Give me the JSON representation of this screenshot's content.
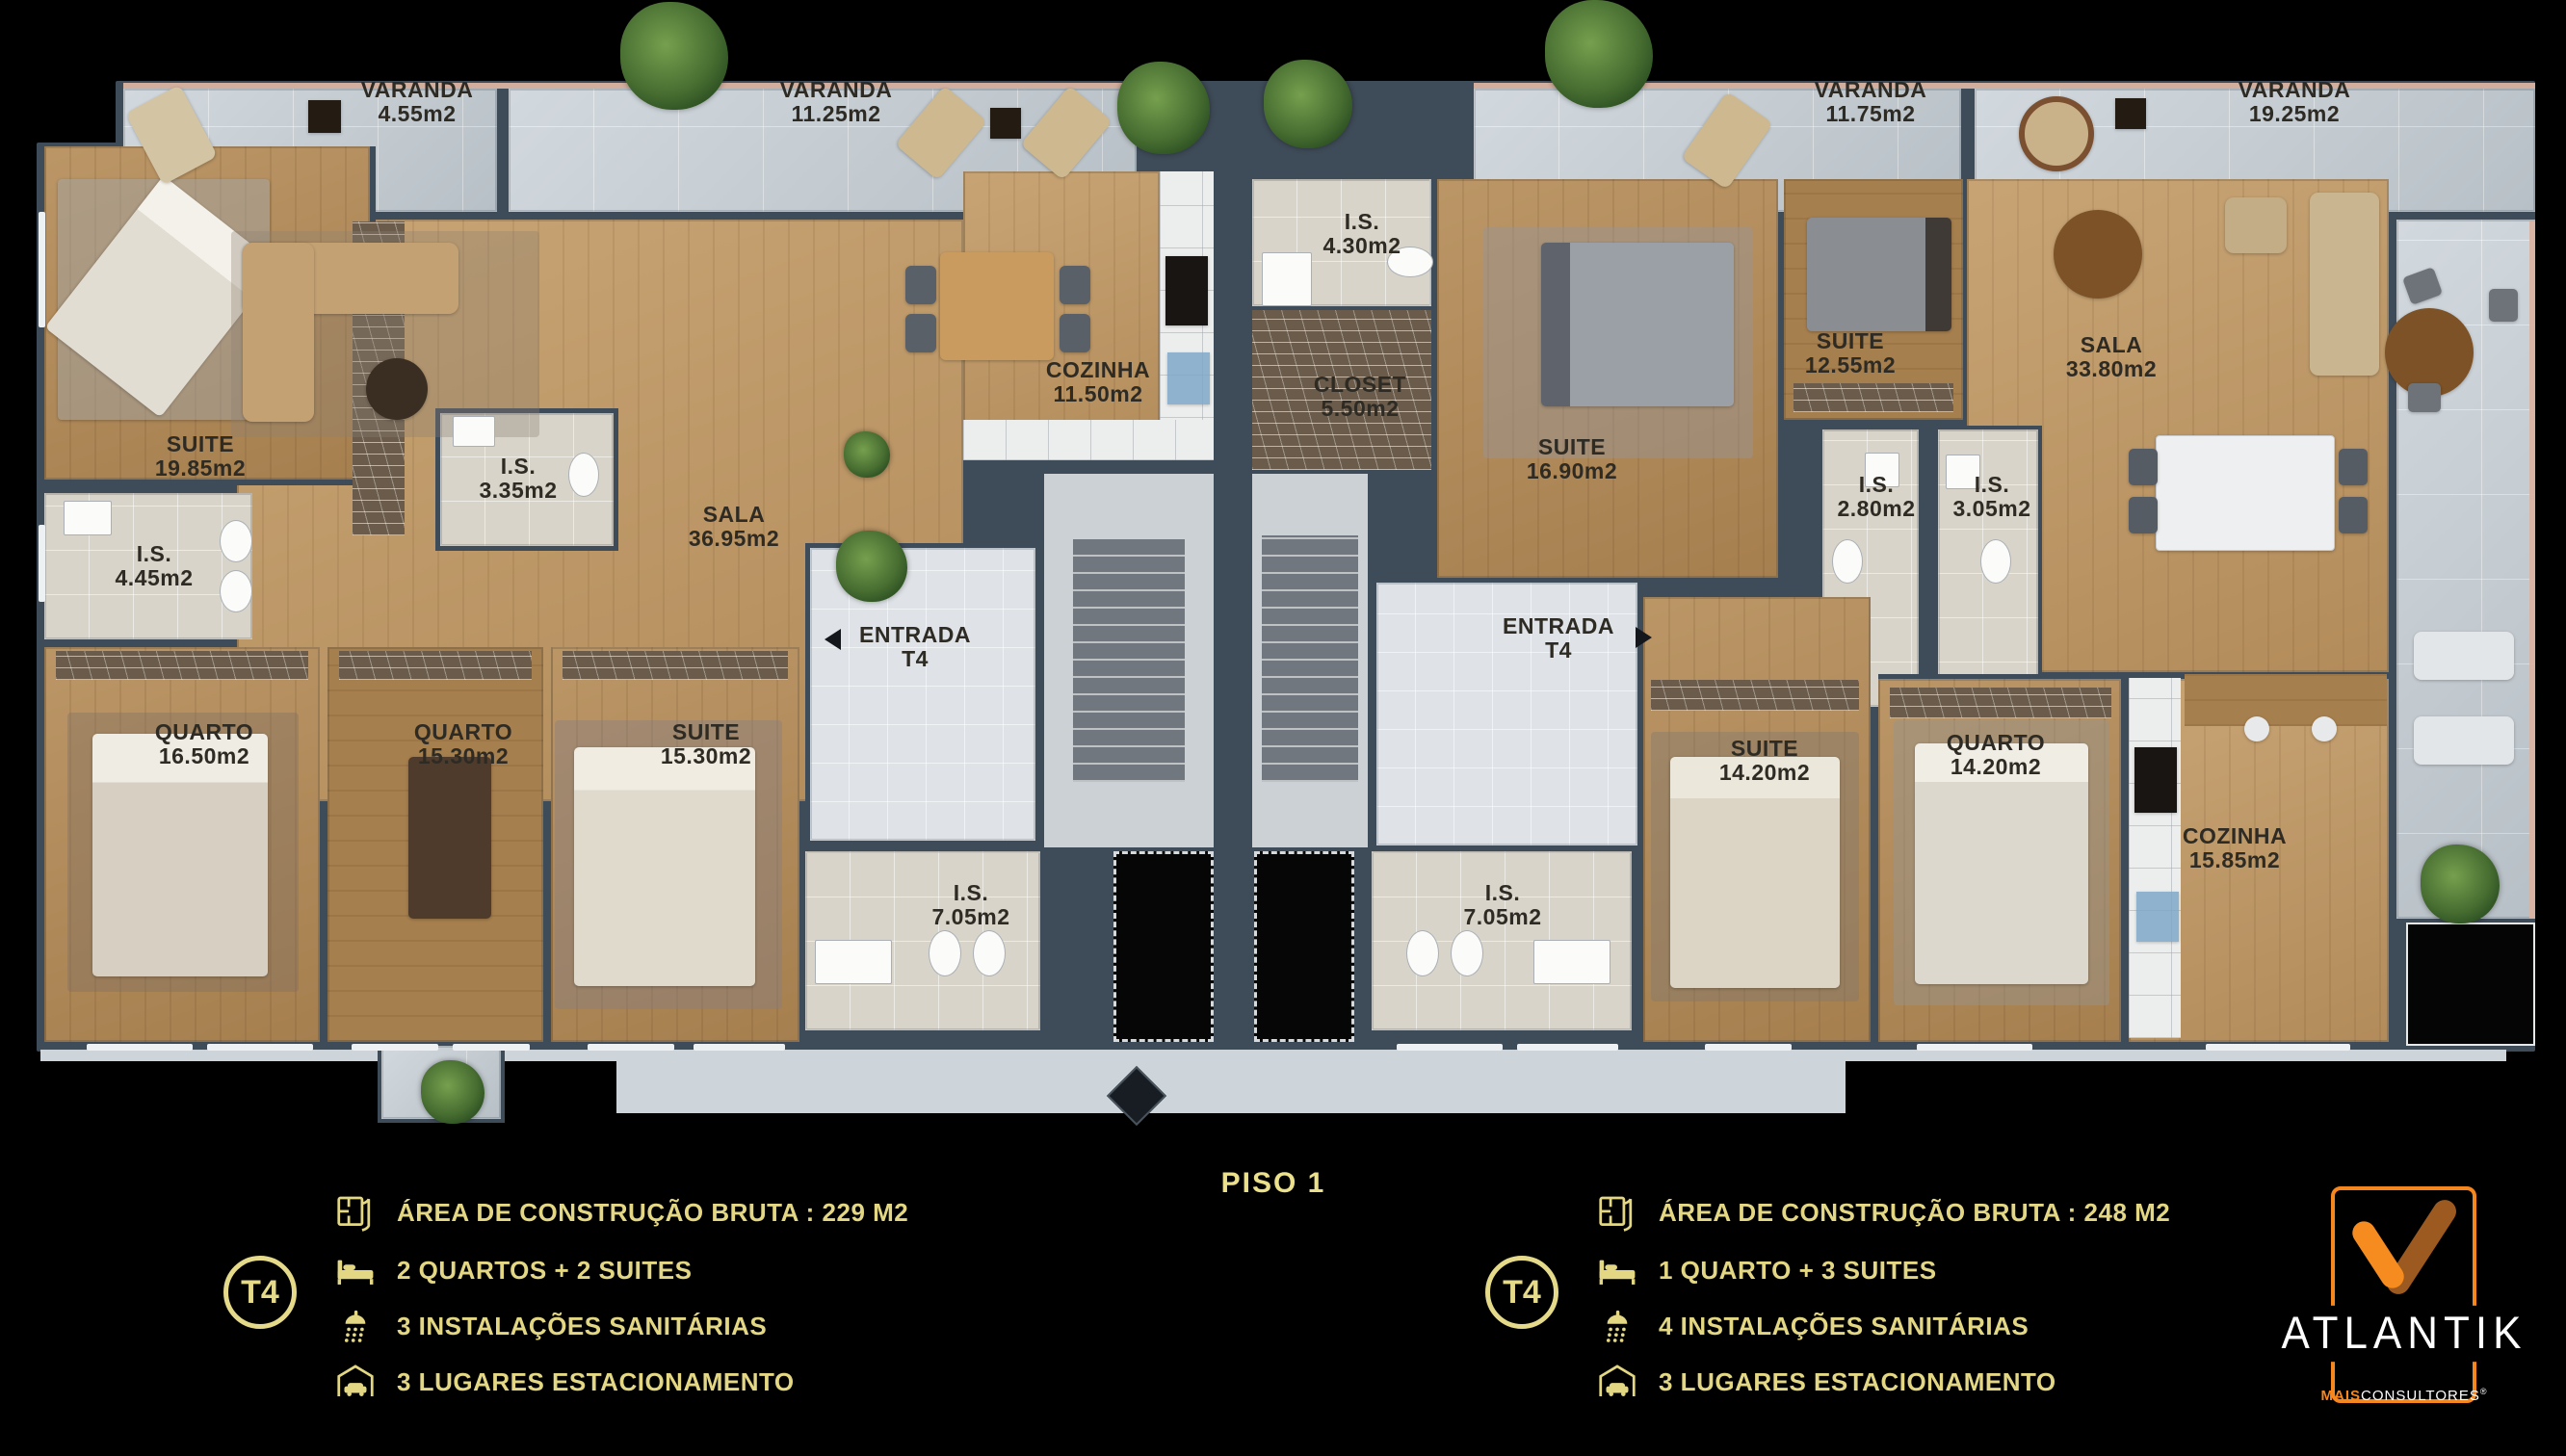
{
  "floor_title": "PISO 1",
  "rooms": {
    "v455": {
      "name": "VARANDA",
      "area": "4.55m2"
    },
    "v1125": {
      "name": "VARANDA",
      "area": "11.25m2"
    },
    "v1175": {
      "name": "VARANDA",
      "area": "11.75m2"
    },
    "v1925": {
      "name": "VARANDA",
      "area": "19.25m2"
    },
    "suite1985": {
      "name": "SUITE",
      "area": "19.85m2"
    },
    "is445": {
      "name": "I.S.",
      "area": "4.45m2"
    },
    "is335": {
      "name": "I.S.",
      "area": "3.35m2"
    },
    "sala3695": {
      "name": "SALA",
      "area": "36.95m2"
    },
    "cozinha1150": {
      "name": "COZINHA",
      "area": "11.50m2"
    },
    "entrada1": {
      "name": "ENTRADA",
      "area": "T4"
    },
    "quarto1650": {
      "name": "QUARTO",
      "area": "16.50m2"
    },
    "quarto1530": {
      "name": "QUARTO",
      "area": "15.30m2"
    },
    "suite1530": {
      "name": "SUITE",
      "area": "15.30m2"
    },
    "is705L": {
      "name": "I.S.",
      "area": "7.05m2"
    },
    "is430": {
      "name": "I.S.",
      "area": "4.30m2"
    },
    "closet550": {
      "name": "CLOSET",
      "area": "5.50m2"
    },
    "suite1690": {
      "name": "SUITE",
      "area": "16.90m2"
    },
    "suite1255": {
      "name": "SUITE",
      "area": "12.55m2"
    },
    "is280": {
      "name": "I.S.",
      "area": "2.80m2"
    },
    "is305": {
      "name": "I.S.",
      "area": "3.05m2"
    },
    "sala3380": {
      "name": "SALA",
      "area": "33.80m2"
    },
    "entrada2": {
      "name": "ENTRADA",
      "area": "T4"
    },
    "suite1420": {
      "name": "SUITE",
      "area": "14.20m2"
    },
    "quarto1420": {
      "name": "QUARTO",
      "area": "14.20m2"
    },
    "cozinha1585": {
      "name": "COZINHA",
      "area": "15.85m2"
    },
    "is705R": {
      "name": "I.S.",
      "area": "7.05m2"
    }
  },
  "units": [
    {
      "badge": "T4",
      "features": [
        {
          "icon": "floorplan-icon",
          "label": "ÁREA DE CONSTRUÇÃO BRUTA :  229 M2"
        },
        {
          "icon": "bed-icon",
          "label": "2 QUARTOS + 2 SUITES"
        },
        {
          "icon": "shower-icon",
          "label": "3 INSTALAÇÕES SANITÁRIAS"
        },
        {
          "icon": "garage-icon",
          "label": "3 LUGARES ESTACIONAMENTO"
        }
      ]
    },
    {
      "badge": "T4",
      "features": [
        {
          "icon": "floorplan-icon",
          "label": "ÁREA DE CONSTRUÇÃO BRUTA :  248 M2"
        },
        {
          "icon": "bed-icon",
          "label": "1 QUARTO + 3 SUITES"
        },
        {
          "icon": "shower-icon",
          "label": "4 INSTALAÇÕES SANITÁRIAS"
        },
        {
          "icon": "garage-icon",
          "label": "3 LUGARES ESTACIONAMENTO"
        }
      ]
    }
  ],
  "logo": {
    "brand": "ATLANTIK",
    "sub_bold": "MAIS",
    "sub_rest": "CONSULTORES",
    "registered": "®"
  },
  "colors": {
    "gold": "#e5d98a",
    "orange": "#f6871f",
    "brown": "#9c5a22"
  }
}
